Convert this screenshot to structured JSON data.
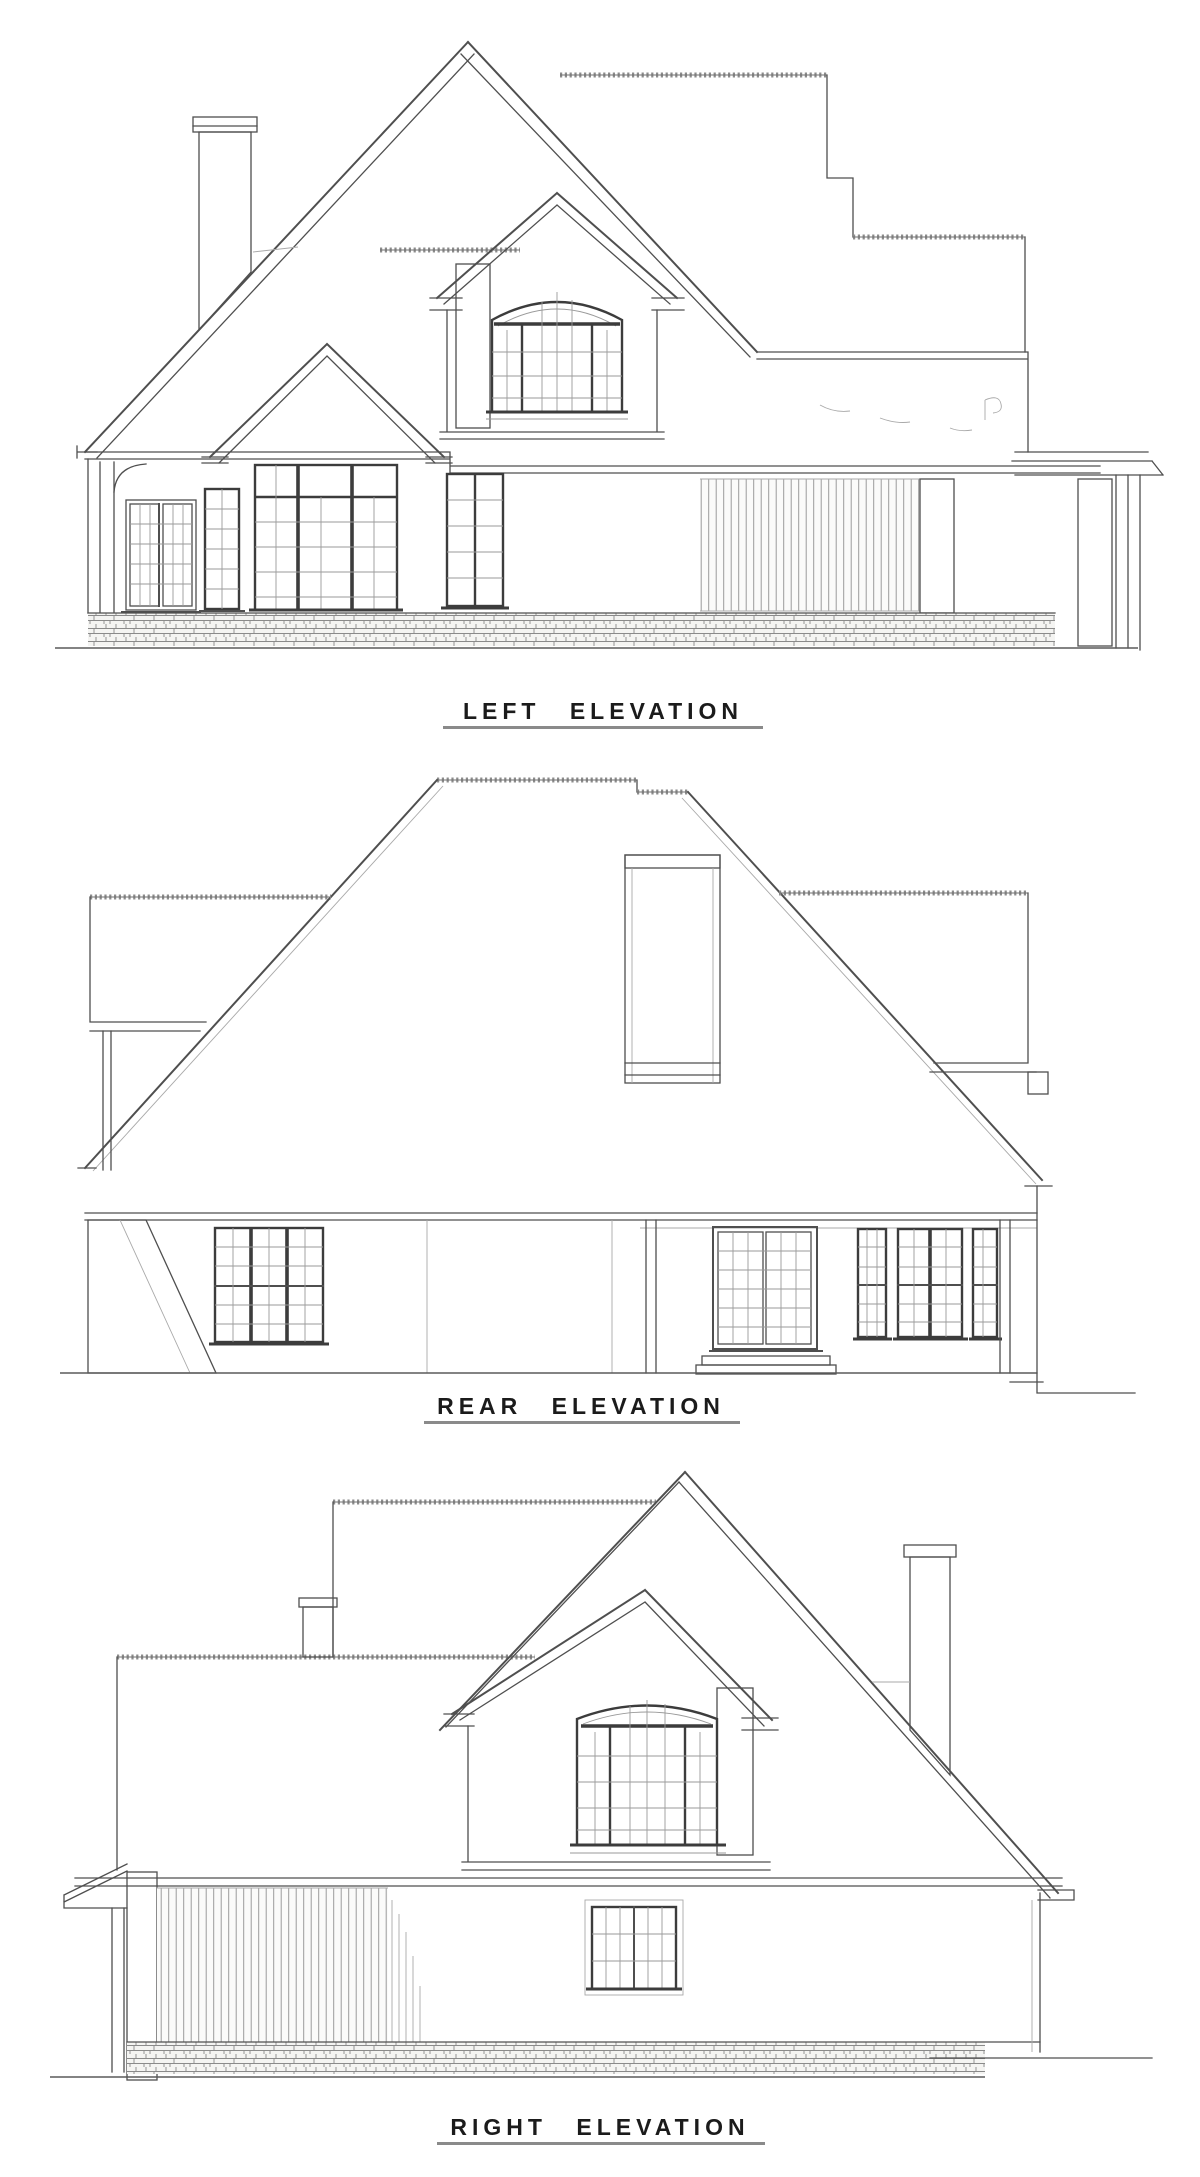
{
  "sheet": {
    "type": "architectural-elevation-sheet",
    "background": "#ffffff"
  },
  "colors": {
    "ink": "#4f4f4f",
    "ink_dark": "#343434",
    "ink_light": "#a9a9a9",
    "label_text": "#1b1b1b"
  },
  "drawings": [
    {
      "id": "left",
      "label": "LEFT ELEVATION"
    },
    {
      "id": "rear",
      "label": "REAR ELEVATION"
    },
    {
      "id": "right",
      "label": "RIGHT ELEVATION"
    }
  ]
}
